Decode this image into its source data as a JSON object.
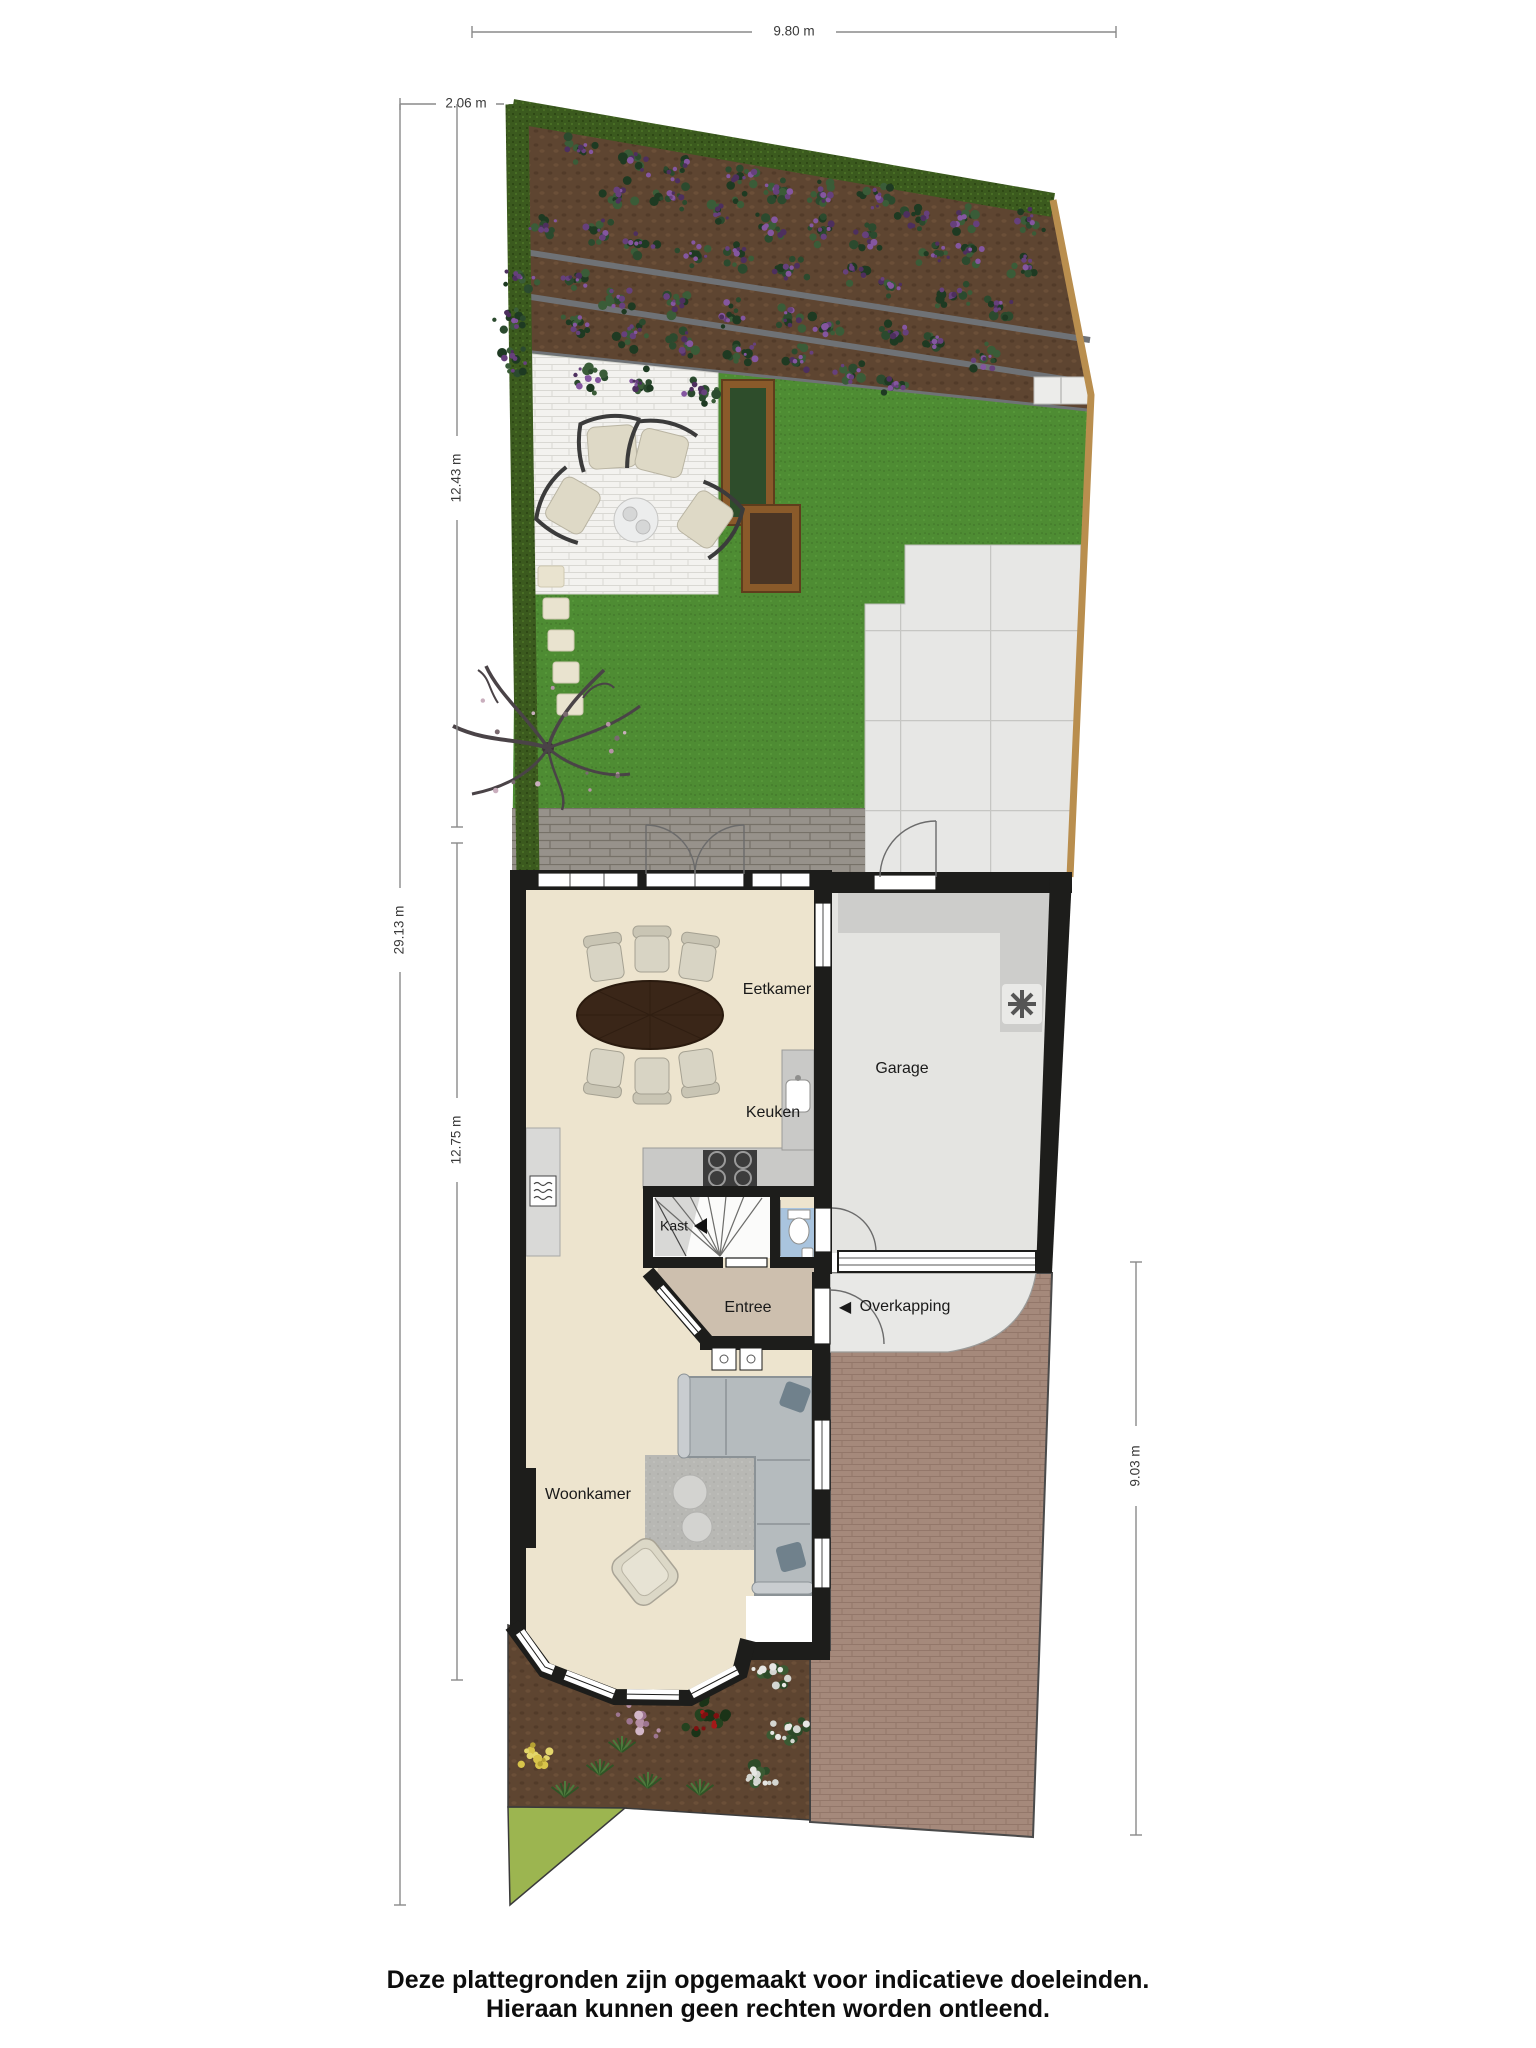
{
  "dimensions": {
    "width_top": "9.80 m",
    "offset_top_left": "2.06 m",
    "depth_total": "29.13 m",
    "depth_garden": "12.43 m",
    "depth_house": "12.75 m",
    "depth_driveway": "9.03 m"
  },
  "rooms": {
    "dining": "Eetkamer",
    "kitchen": "Keuken",
    "garage": "Garage",
    "closet": "Kast",
    "entrance": "Entree",
    "canopy": "Overkapping",
    "living": "Woonkamer"
  },
  "icons": {
    "canopy_arrow": "◀"
  },
  "disclaimer": {
    "line1": "Deze plattegronden zijn opgemaakt voor indicatieve doeleinden.",
    "line2": "Hieraan kunnen geen rechten worden ontleend."
  },
  "colors": {
    "wall": "#1d1d1b",
    "label": "#1a1a1a",
    "floor_main": "#ede4ce",
    "floor_hall": "#cdbfae",
    "floor_toilet": "#a9c4de",
    "floor_garage": "#e4e4e1",
    "lawn": "#4e8c33",
    "hedge": "#3b5a1e",
    "soil": "#5e4531",
    "patio_brick": "#f3f2ef",
    "terrace_brick": "#95908a",
    "concrete": "#e7e7e5",
    "driveway_brick": "#a5897b",
    "planter_wood": "#8a5a2a",
    "grass_triangle": "#9cb550",
    "fence": "#b98e4e"
  }
}
